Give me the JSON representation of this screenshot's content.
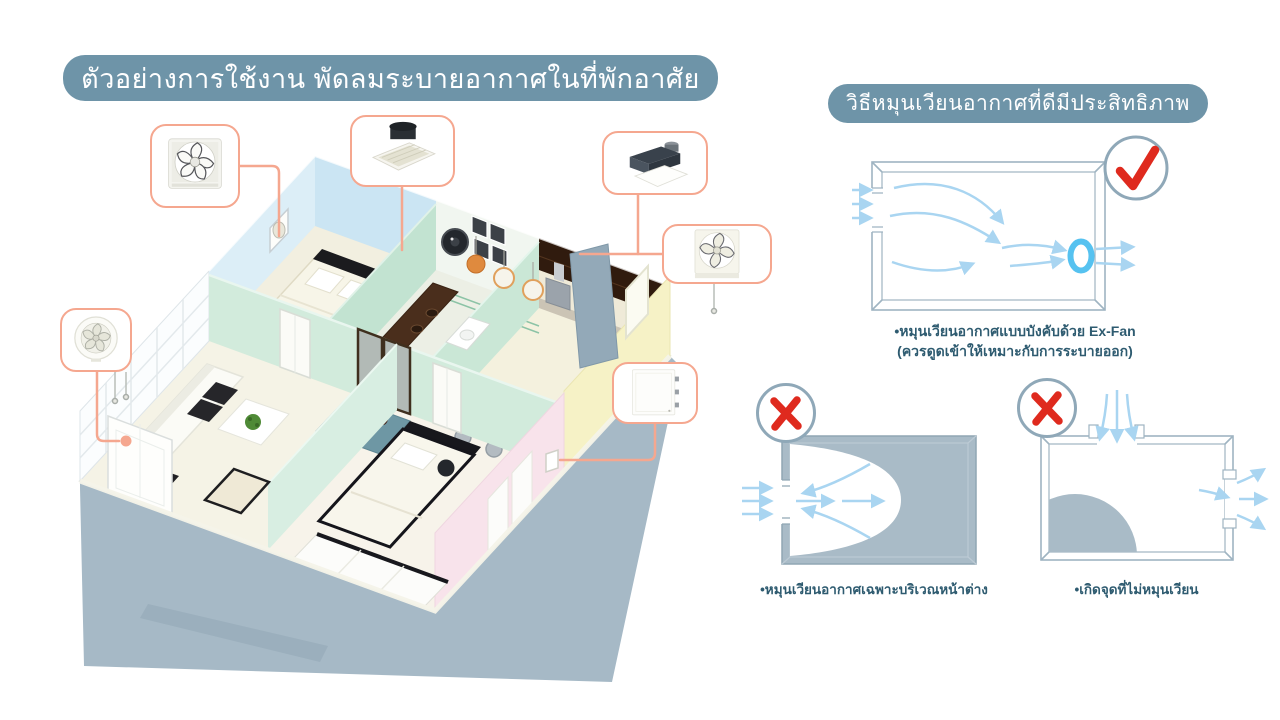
{
  "colors": {
    "banner_bg": "#6E94A8",
    "banner_text": "#FFFFFF",
    "connector_salmon": "#F5A78F",
    "caption_text": "#2E5B70",
    "airflow_blue": "#A9D5F1",
    "exfan_ring_blue": "#56C2F0",
    "dead_zone_gray": "#A9BBC7",
    "diagram_frame_gray": "#9FB4C2",
    "mark_red": "#DF2A1E"
  },
  "left_section": {
    "title": "ตัวอย่างการใช้งาน พัดลมระบายอากาศในที่พักอาศัย",
    "fan_callouts": [
      {
        "icon": "wall-exhaust-fan-icon"
      },
      {
        "icon": "ceiling-cassette-fan-icon"
      },
      {
        "icon": "ducted-ceiling-fan-icon"
      },
      {
        "icon": "wall-shutter-fan-icon"
      },
      {
        "icon": "flat-panel-fan-icon"
      },
      {
        "icon": "round-exhaust-fan-icon"
      }
    ]
  },
  "right_section": {
    "title": "วิธีหมุนเวียนอากาศที่ดีมีประสิทธิภาพ",
    "diagrams": [
      {
        "name": "forced-exfan-circulation",
        "verdict": "correct",
        "caption_line1": "•หมุนเวียนอากาศแบบบังคับด้วย Ex-Fan",
        "caption_line2": "(ควรดูดเข้าให้เหมาะกับการระบายออก)"
      },
      {
        "name": "window-only-circulation",
        "verdict": "incorrect",
        "caption_line1": "•หมุนเวียนอากาศเฉพาะบริเวณหน้าต่าง"
      },
      {
        "name": "stagnant-spot",
        "verdict": "incorrect",
        "caption_line1": "•เกิดจุดที่ไม่หมุนเวียน"
      }
    ]
  }
}
